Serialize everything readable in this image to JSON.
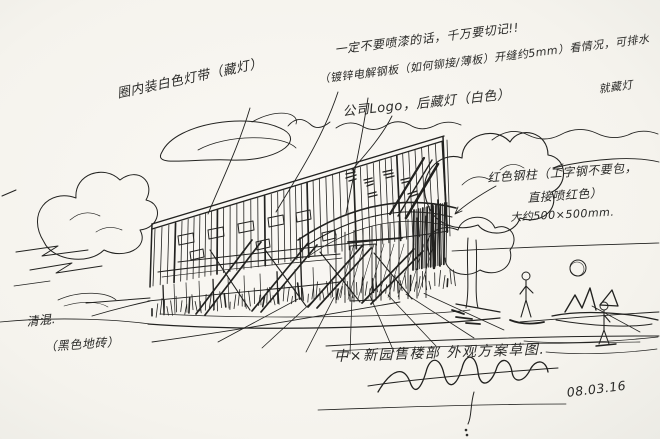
{
  "palette": {
    "paper": "#f7f5f0",
    "ink": "#222220"
  },
  "annotations": {
    "facade_light": "圈内装白色灯带（藏灯）",
    "warning": "一定不要喷漆的话，千万要切记!!",
    "panel_spec": "（镀锌电解钢板（如何铆接/薄板）开缝约5mm）看情况，可排水",
    "panel_spec_2": "就藏灯",
    "logo_note": "公司Logo，后藏灯（白色）",
    "column_note_line1": "红色钢柱（工字钢不要包，",
    "column_note_line2": "直接喷红色）",
    "column_size": "大约500×500mm.",
    "concrete_note": "清混.",
    "tile_note": "（黑色地砖）",
    "title": "中×新园售楼部 外观方案草图.",
    "date": "08.03.16"
  }
}
